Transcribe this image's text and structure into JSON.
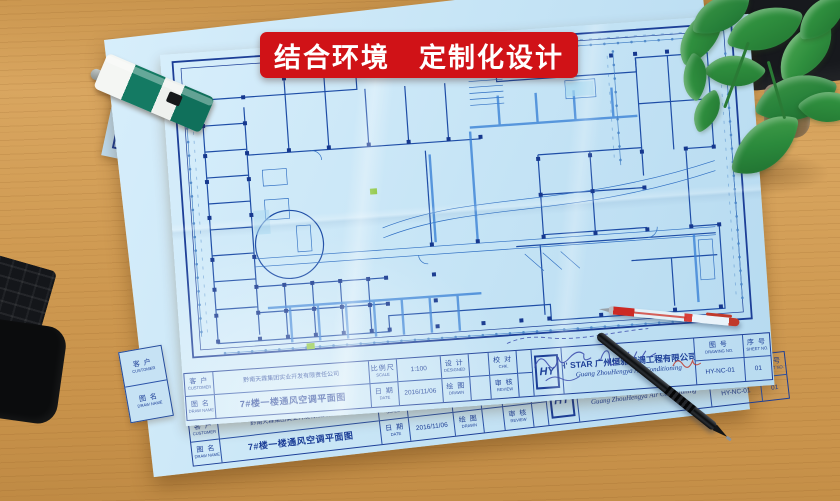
{
  "banner": {
    "text": "结合环境　定制化设计"
  },
  "title_block": {
    "customer": {
      "label": "客 户",
      "label_en": "CUSTOMER",
      "value": "黔南天霖集团实业开发有限责任公司"
    },
    "draw_name": {
      "label": "图 名",
      "label_en": "DRAW NAME",
      "value": "7#楼一楼通风空调平面图"
    },
    "scale": {
      "label": "比例尺",
      "label_en": "SCALE",
      "value": "1:100"
    },
    "date": {
      "label": "日 期",
      "label_en": "DATE",
      "value": "2016/11/06"
    },
    "designed": {
      "label": "设 计",
      "label_en": "DESIGNED",
      "value": ""
    },
    "drawn": {
      "label": "绘 图",
      "label_en": "DRAWN",
      "value": ""
    },
    "checked": {
      "label": "校 对",
      "label_en": "CHK.",
      "value": ""
    },
    "reviewed": {
      "label": "审 核",
      "label_en": "REVIEW",
      "value": ""
    },
    "logo_text": "HY",
    "company_cn": "H' STAR 广州恒雅空调工程有限公司",
    "company_en": "Guang ZhouHengya Air Conditioning",
    "drawing_no": {
      "label": "图 号",
      "label_en": "DRAWING NO.",
      "value": "HY-NC-01"
    },
    "sheet_no": {
      "label": "序 号",
      "label_en": "SHEET NO.",
      "value": "01"
    }
  },
  "colors": {
    "banner_red": "#d01217",
    "paper_blue": "#c7e5f6",
    "ink_navy": "#1c3e97",
    "line_blue": "#2e6ec2",
    "desk_wood": "#cf9a52",
    "stapler_teal": "#147a63",
    "pen_red": "#cc2a24",
    "highlight_green": "#8bc63f"
  },
  "scene_objects": [
    "blueprint-sheets",
    "green-stapler",
    "red-ballpoint-pen",
    "black-pen",
    "pothos-plant",
    "black-keyboard-edge",
    "handwritten-notes"
  ]
}
